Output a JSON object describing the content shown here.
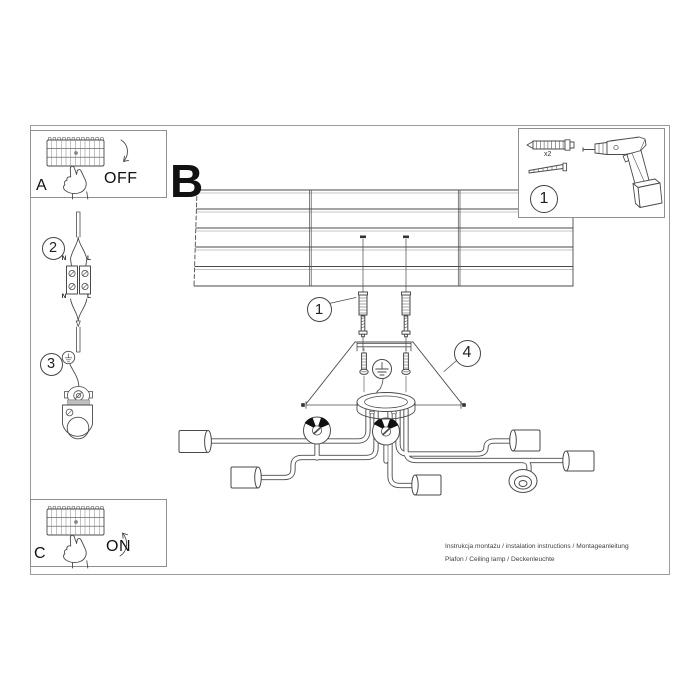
{
  "labels": {
    "panel_a": "A",
    "panel_b": "B",
    "panel_c": "C",
    "power_off": "OFF",
    "power_on": "ON",
    "anchor_qty": "x2",
    "wire_top_n": "N",
    "wire_top_l": "L",
    "wire_bottom_n": "N",
    "wire_bottom_l": "L"
  },
  "steps": {
    "tools": "1",
    "drill_marks": "1",
    "connect_wires": "2",
    "ground": "3",
    "cover": "4"
  },
  "footer": {
    "line1": "Instrukcja montażu / instalation instructions / Montageanleitung",
    "line2": "Plafon / Ceiling lamp / Deckenleuchte"
  },
  "icons": {
    "fuse_box": "circuit-breaker-row",
    "pointing_hand": "hand-pressing-switch",
    "arrow_off": "curved-arrow-down",
    "arrow_on": "curved-arrow-up",
    "wall_anchor": "expansion-plug",
    "screw": "mounting-screw",
    "drill": "power-drill",
    "ground_symbol": "earth-ground",
    "terminal_block": "luster-terminal",
    "bracket": "mounting-bracket",
    "ceiling": "wood-plank-ceiling",
    "lamp": "six-arm-ceiling-lamp"
  },
  "colors": {
    "line": "#4a4a4a",
    "panel_border": "#8f8f8f",
    "text": "#1a1a1a",
    "muted_text": "#3f3f3f"
  }
}
